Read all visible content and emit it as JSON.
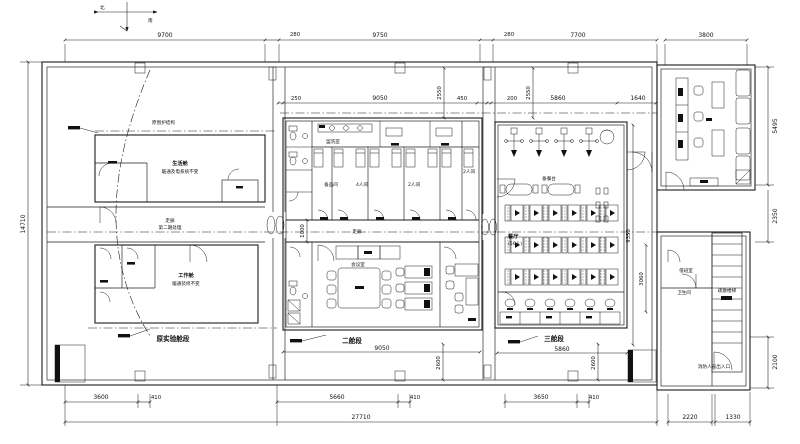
{
  "compass": {
    "a": "北",
    "b": "南"
  },
  "dims": {
    "top1": "9700",
    "top2": "280",
    "top3": "9750",
    "top4": "280",
    "top5": "7700",
    "top6": "3800",
    "left1": "14710",
    "mid1": "250",
    "mid2": "9050",
    "mid3": "450",
    "mid4": "200",
    "mid5": "5860",
    "mid6": "1640",
    "v2550a": "2550",
    "v2550b": "2550",
    "v1000": "1000",
    "v9350": "9350",
    "v3060": "3060",
    "v2600a": "2600",
    "v2600b": "2600",
    "r5495": "5495",
    "r2350": "2350",
    "r2100": "2100",
    "bot9050": "9050",
    "bot5860": "5860",
    "b3600": "3600",
    "b410a": "410",
    "b5660": "5660",
    "b410b": "410",
    "b3650": "3650",
    "b410c": "410",
    "b2220": "2220",
    "b1330": "1330",
    "btotal": "27710"
  },
  "labels": {
    "section_left": "原实验舱段",
    "section_mid": "二舱段",
    "section_right": "三舱段",
    "room_life1": "生活舱",
    "room_life2": "暖通及电系统不变",
    "room_work1": "工作舱",
    "room_work2": "暖通装修不变",
    "corridor_left1": "走廊",
    "corridor_left2": "第二期处理",
    "corridor_mid": "走廊",
    "washroom": "盥洗室",
    "storage": "备品间",
    "room4": "4人间",
    "room2a": "2人间",
    "room2b": "2人间",
    "meeting": "会议室",
    "canteen1": "餐厅",
    "canteen2": "(56人)",
    "servery": "备餐台",
    "stair": "疏散楼梯",
    "stair_exit": "消防人员出入口",
    "duty1": "值班室",
    "duty2": "卫生间",
    "note_left": "原围护结构"
  }
}
